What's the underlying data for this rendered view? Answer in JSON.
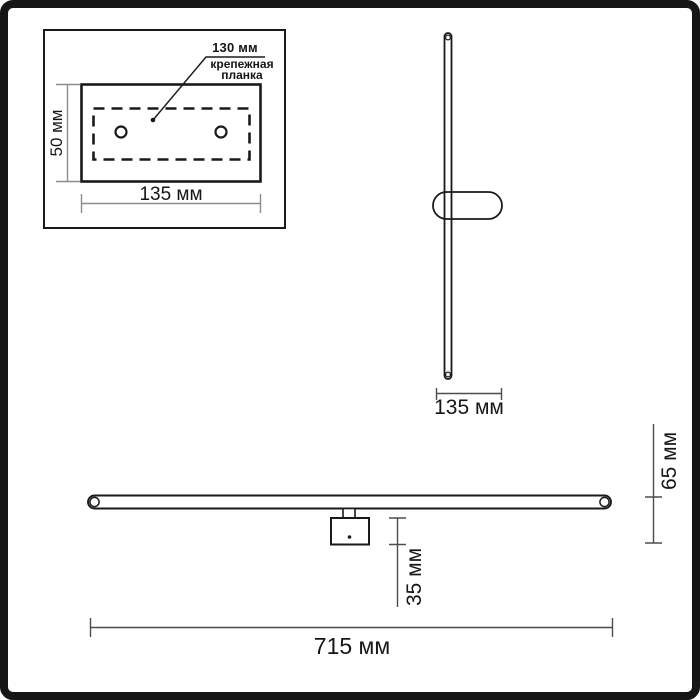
{
  "diagram_title": "Wall light fixture dimension drawing",
  "colors": {
    "object_line": "#1a1a1a",
    "dimension_line": "#8c8c8c",
    "dimension_line_dark": "#4d4d4d",
    "frame": "#161616",
    "background": "#ffffff"
  },
  "mounting_plate_inset": {
    "hole_spacing_label": "130 мм",
    "plate_caption": "крепежная планка",
    "plate_height_label": "50 мм",
    "plate_width_label": "135 мм"
  },
  "side_view": {
    "fixture_depth_label": "135 мм"
  },
  "front_view": {
    "overall_width_label": "715 мм",
    "canopy_depth_label": "35 мм",
    "overall_depth_label": "65 мм"
  }
}
